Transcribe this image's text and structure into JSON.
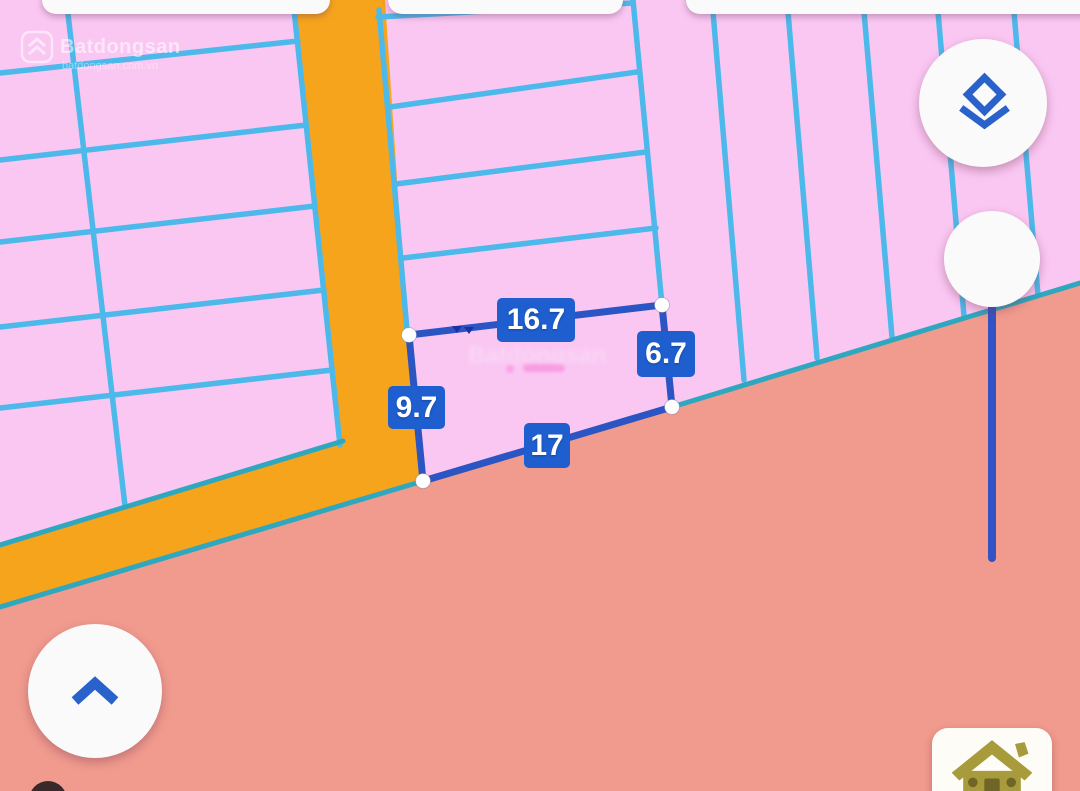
{
  "watermark": {
    "brand": "Batdongsan",
    "domain": "batdongsan.com.vn"
  },
  "ghost_watermark": {
    "text": "Batdongsan"
  },
  "parcel": {
    "measurements": {
      "top": "16.7",
      "right": "6.7",
      "left": "9.7",
      "bottom": "17"
    },
    "vertex_count": 4
  },
  "icons": {
    "layers": "layers-icon",
    "collapse": "chevron-up-icon",
    "home": "house-icon",
    "brand_logo": "brand-chevrons-icon"
  },
  "colors": {
    "pink": "#fac7f3",
    "salmon": "#f19b8e",
    "orange": "#f7a41d",
    "line_blue": "#4cb9ea",
    "teal_line": "#2ea7bf",
    "parcel_blue": "#2c55c4",
    "label_blue": "#1e5ecf",
    "accent_blue": "#2a62cc",
    "track_blue": "#3353c4",
    "olive": "#a79b3c",
    "card_white": "#fbfafa"
  }
}
